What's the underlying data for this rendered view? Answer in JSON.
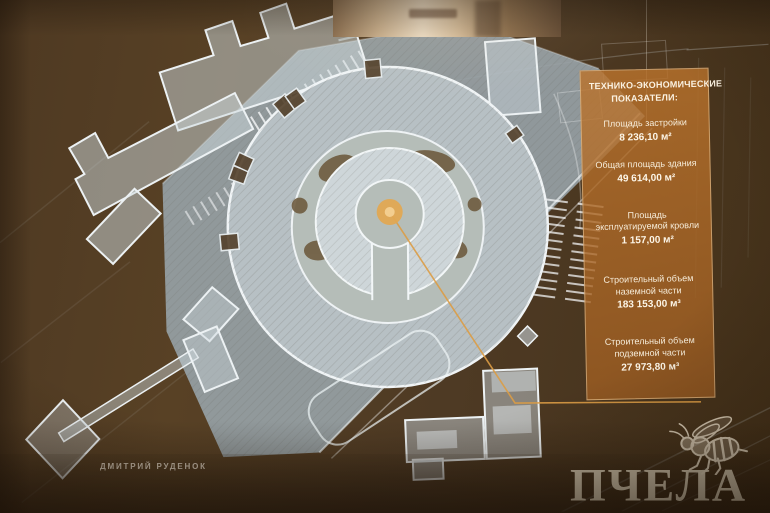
{
  "slide": {
    "panel": {
      "title_lines": [
        "ТЕХНИКО-ЭКОНОМИЧЕСКИЕ",
        "ПОКАЗАТЕЛИ:"
      ],
      "metrics": [
        {
          "label": "Площадь застройки",
          "value": "8 236,10 м²"
        },
        {
          "label": "Общая площадь здания",
          "value": "49 614,00 м²"
        },
        {
          "label": "Площадь эксплуатируемой кровли",
          "value": "1 157,00 м²"
        },
        {
          "label": "Строительный объем наземной части",
          "value": "183 153,00 м³"
        },
        {
          "label": "Строительный объем подземной части",
          "value": "27 973,80 м³"
        }
      ]
    }
  },
  "photo": {
    "credit": "ДМИТРИЙ РУДЕНОК",
    "watermark_text": "ПЧЕЛА"
  },
  "colors": {
    "panel_orange": "#b06f2c",
    "accent_orange": "#dda14e",
    "building_light": "#c6d0d4",
    "plaza_gray": "#98a2a8",
    "background_brown": "#4a3520",
    "watermark_beige": "#d8ccb6"
  }
}
